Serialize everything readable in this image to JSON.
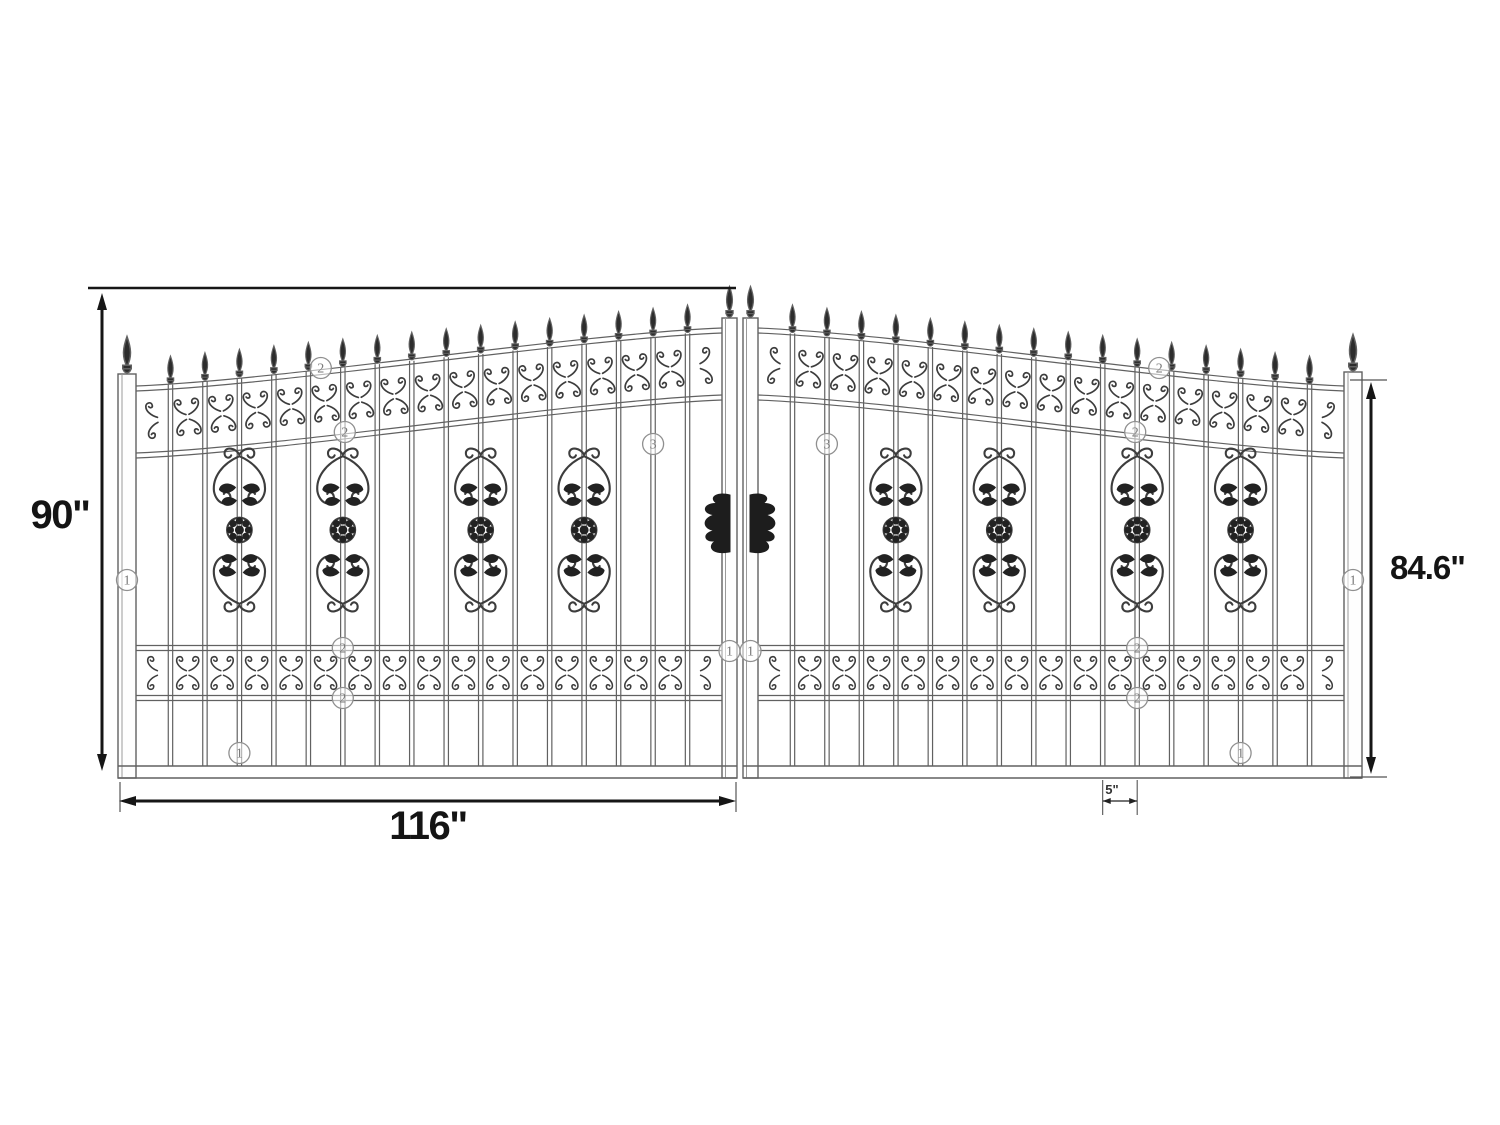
{
  "diagram": {
    "description": "Dimensioned line drawing of a dual-swing arched ornamental wrought iron driveway gate, two mirrored leaves with spear finials, scroll medallions and circled part callouts",
    "dimensions": {
      "overall_height": "90\"",
      "leaf_width": "116\"",
      "outer_height": "84.6\"",
      "picket_gap": "5\""
    },
    "callouts": [
      "1",
      "2",
      "3"
    ],
    "colors": {
      "background": "#ffffff",
      "line": "#616161",
      "ornament": "#3d3d3d",
      "fill_dark": "#222222",
      "dimension": "#161616",
      "callout": "#8f8f8f"
    }
  }
}
